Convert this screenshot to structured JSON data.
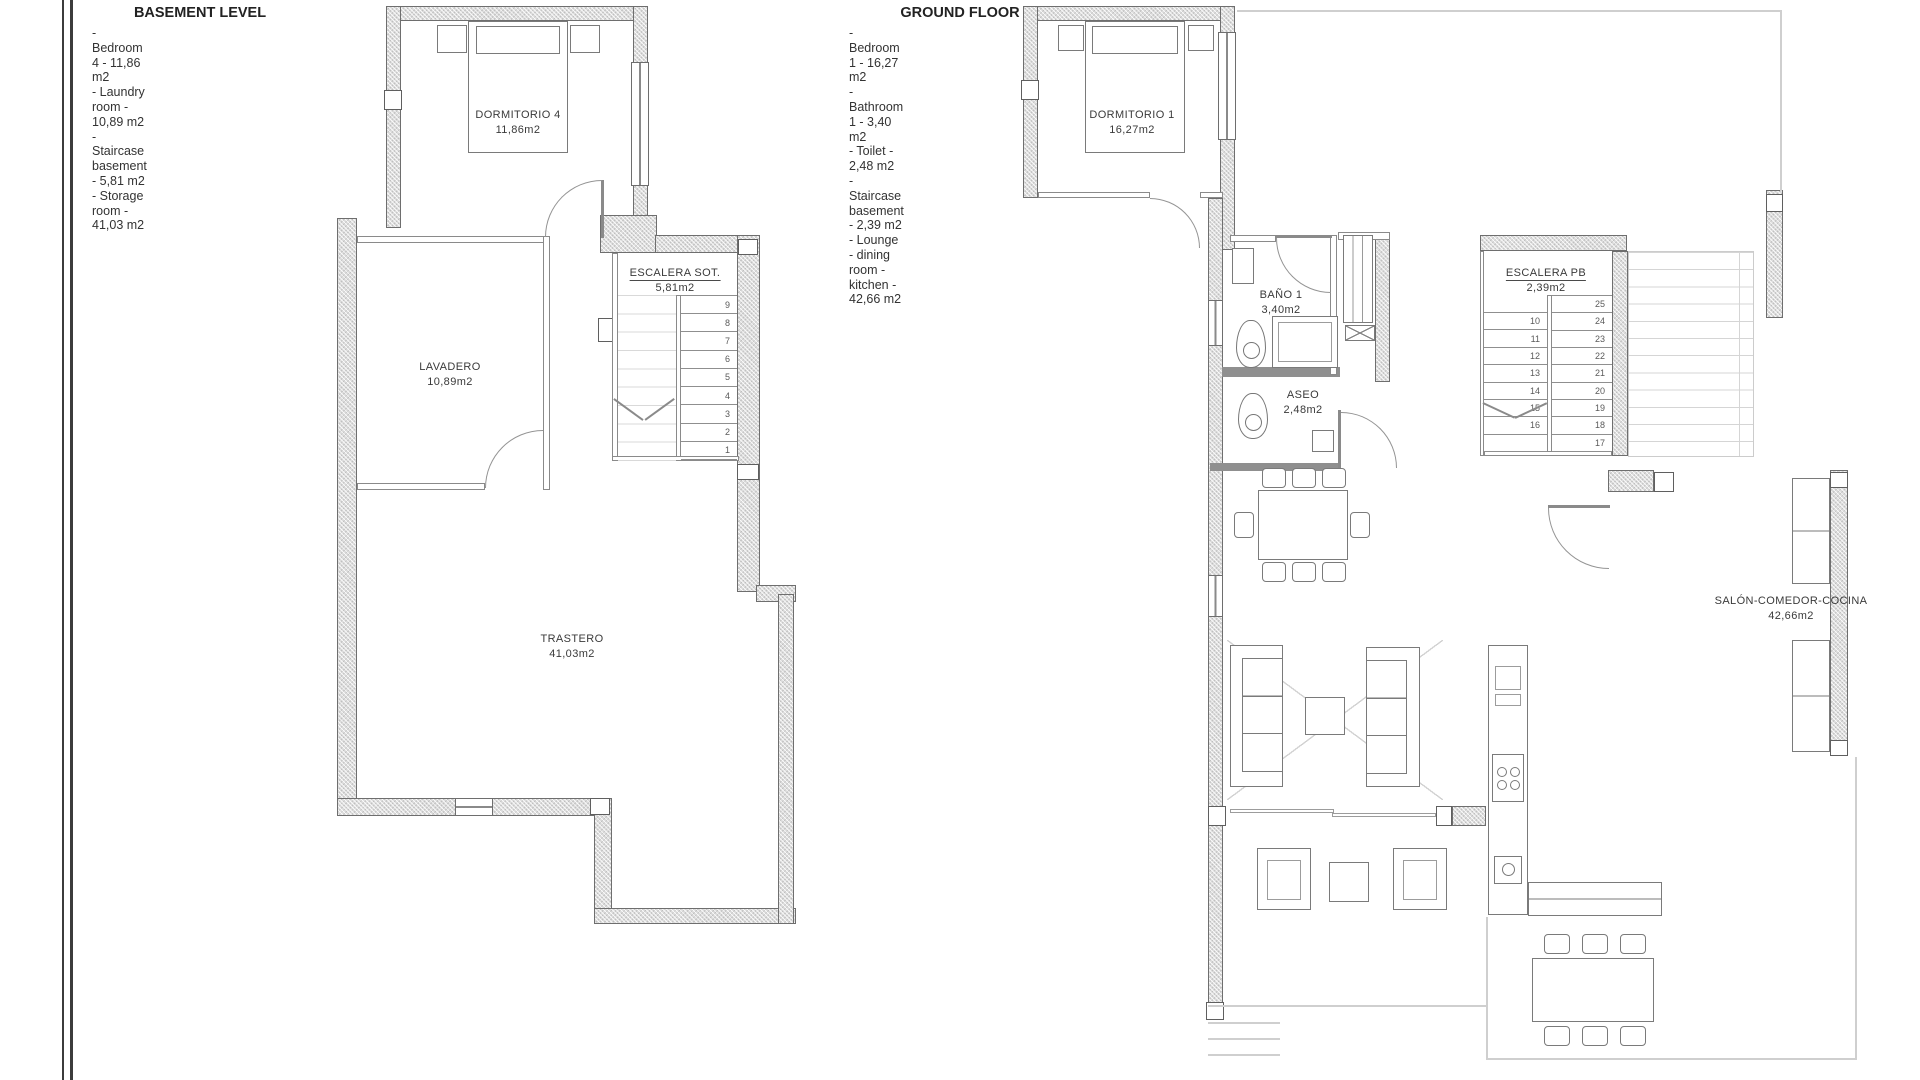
{
  "colors": {
    "wall_fill": "#dcdcdc",
    "wall_line": "#6e6e6e",
    "thin_line": "#8a8a8a",
    "faint_line": "#cfcfcf",
    "text": "#3a3a3a"
  },
  "legends": {
    "basement": {
      "title": "BASEMENT LEVEL",
      "items": "- Bedroom 4 - 11,86 m2\n- Laundry room - 10,89 m2\n- Staircase basement - 5,81 m2\n- Storage room - 41,03 m2"
    },
    "ground": {
      "title": "GROUND FLOOR",
      "items": "- Bedroom 1 - 16,27 m2\n- Bathroom 1 - 3,40 m2\n- Toilet - 2,48 m2\n- Staircase basement - 2,39 m2\n- Lounge - dining room - kitchen - 42,66 m2"
    }
  },
  "basement_plan": {
    "rooms": {
      "dormitorio4": {
        "name": "DORMITORIO  4",
        "area": "11,86m2"
      },
      "lavadero": {
        "name": "LAVADERO",
        "area": "10,89m2"
      },
      "escalera": {
        "name": "ESCALERA  SOT.",
        "area": "5,81m2"
      },
      "trastero": {
        "name": "TRASTERO",
        "area": "41,03m2"
      }
    },
    "stair_steps": [
      "9",
      "8",
      "7",
      "6",
      "5",
      "4",
      "3",
      "2",
      "1"
    ]
  },
  "ground_plan": {
    "rooms": {
      "dormitorio1": {
        "name": "DORMITORIO  1",
        "area": "16,27m2"
      },
      "bano1": {
        "name": "BAÑO  1",
        "area": "3,40m2"
      },
      "aseo": {
        "name": "ASEO",
        "area": "2,48m2"
      },
      "escalera": {
        "name": "ESCALERA  PB",
        "area": "2,39m2"
      },
      "salon": {
        "name": "SALÓN-COMEDOR-COCINA",
        "area": "42,66m2"
      }
    },
    "stair_steps_left": [
      "10",
      "11",
      "12",
      "13",
      "14",
      "15",
      "16",
      ""
    ],
    "stair_steps_right": [
      "25",
      "24",
      "23",
      "22",
      "21",
      "20",
      "19",
      "18",
      "17"
    ]
  }
}
